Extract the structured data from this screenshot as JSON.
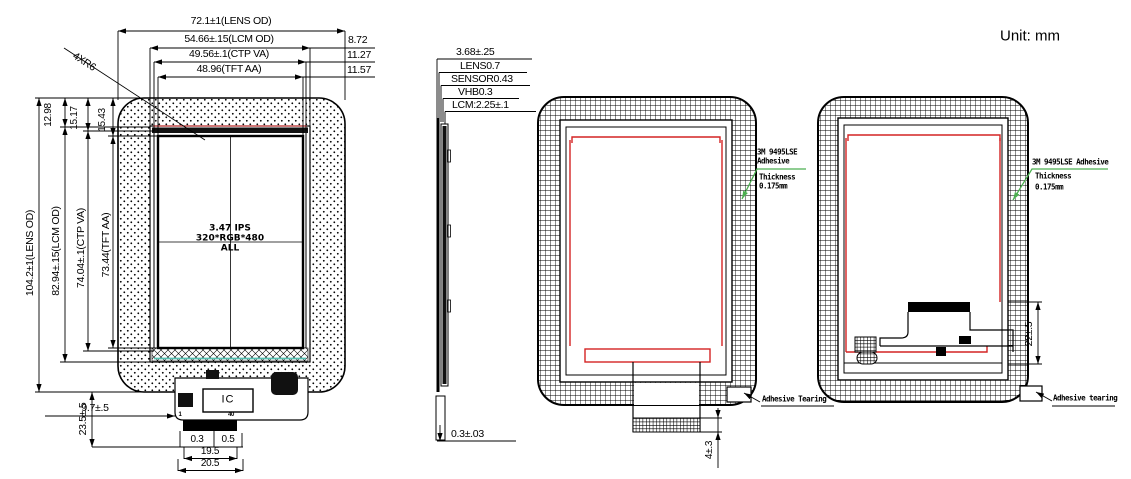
{
  "header": {
    "unit_label": "Unit: mm"
  },
  "colors": {
    "red_trace": "#d42323",
    "green_leader": "#4caf50",
    "teal_tape": "#58c0b2",
    "line": "#000000"
  },
  "front_view": {
    "top_dims": [
      "72.1±1(LENS OD)",
      "54.66±.15(LCM OD)",
      "49.56±.1(CTP VA)",
      "48.96(TFT AA)"
    ],
    "side_margins": [
      "8.72",
      "11.27",
      "11.57"
    ],
    "left_dims": [
      "104.2±1(LENS OD)",
      "82.94±.15(LCM OD)",
      "74.04±.1(CTP VA)",
      "73.44(TFT AA)"
    ],
    "top_margins": [
      "12.98",
      "15.17",
      "15.43"
    ],
    "corner_radius": "4XR6",
    "display_text": [
      "3.47 IPS",
      "320*RGB*480",
      "ALL"
    ],
    "ic_label": "IC",
    "pin_first": "1",
    "pin_last": "40",
    "fpc_drop": "23.5±.5",
    "ic_offset": "9.7±.5",
    "pin_width": "0.3",
    "pin_pitch": "0.5",
    "connector_width": "19.5",
    "tail_width": "20.5"
  },
  "side_view": {
    "stack_labels": [
      "3.68±.25",
      "LENS0.7",
      "SENSOR0.43",
      "VHB0.3",
      "LCM:2.25±.1"
    ],
    "tail_thickness": "0.3±.03"
  },
  "rear_view_center": {
    "adhesive_label": [
      "3M 9495LSE",
      "Adhesive",
      "Thickness",
      "0.175mm"
    ],
    "tearing_label": "Adhesive Tearing",
    "tail_length": "4±.3"
  },
  "rear_view_right": {
    "adhesive_label": [
      "3M 9495LSE Adhesive",
      "Thickness",
      "0.175mm"
    ],
    "tearing_label": "Adhesive tearing",
    "fpc_height": "22±.5"
  }
}
